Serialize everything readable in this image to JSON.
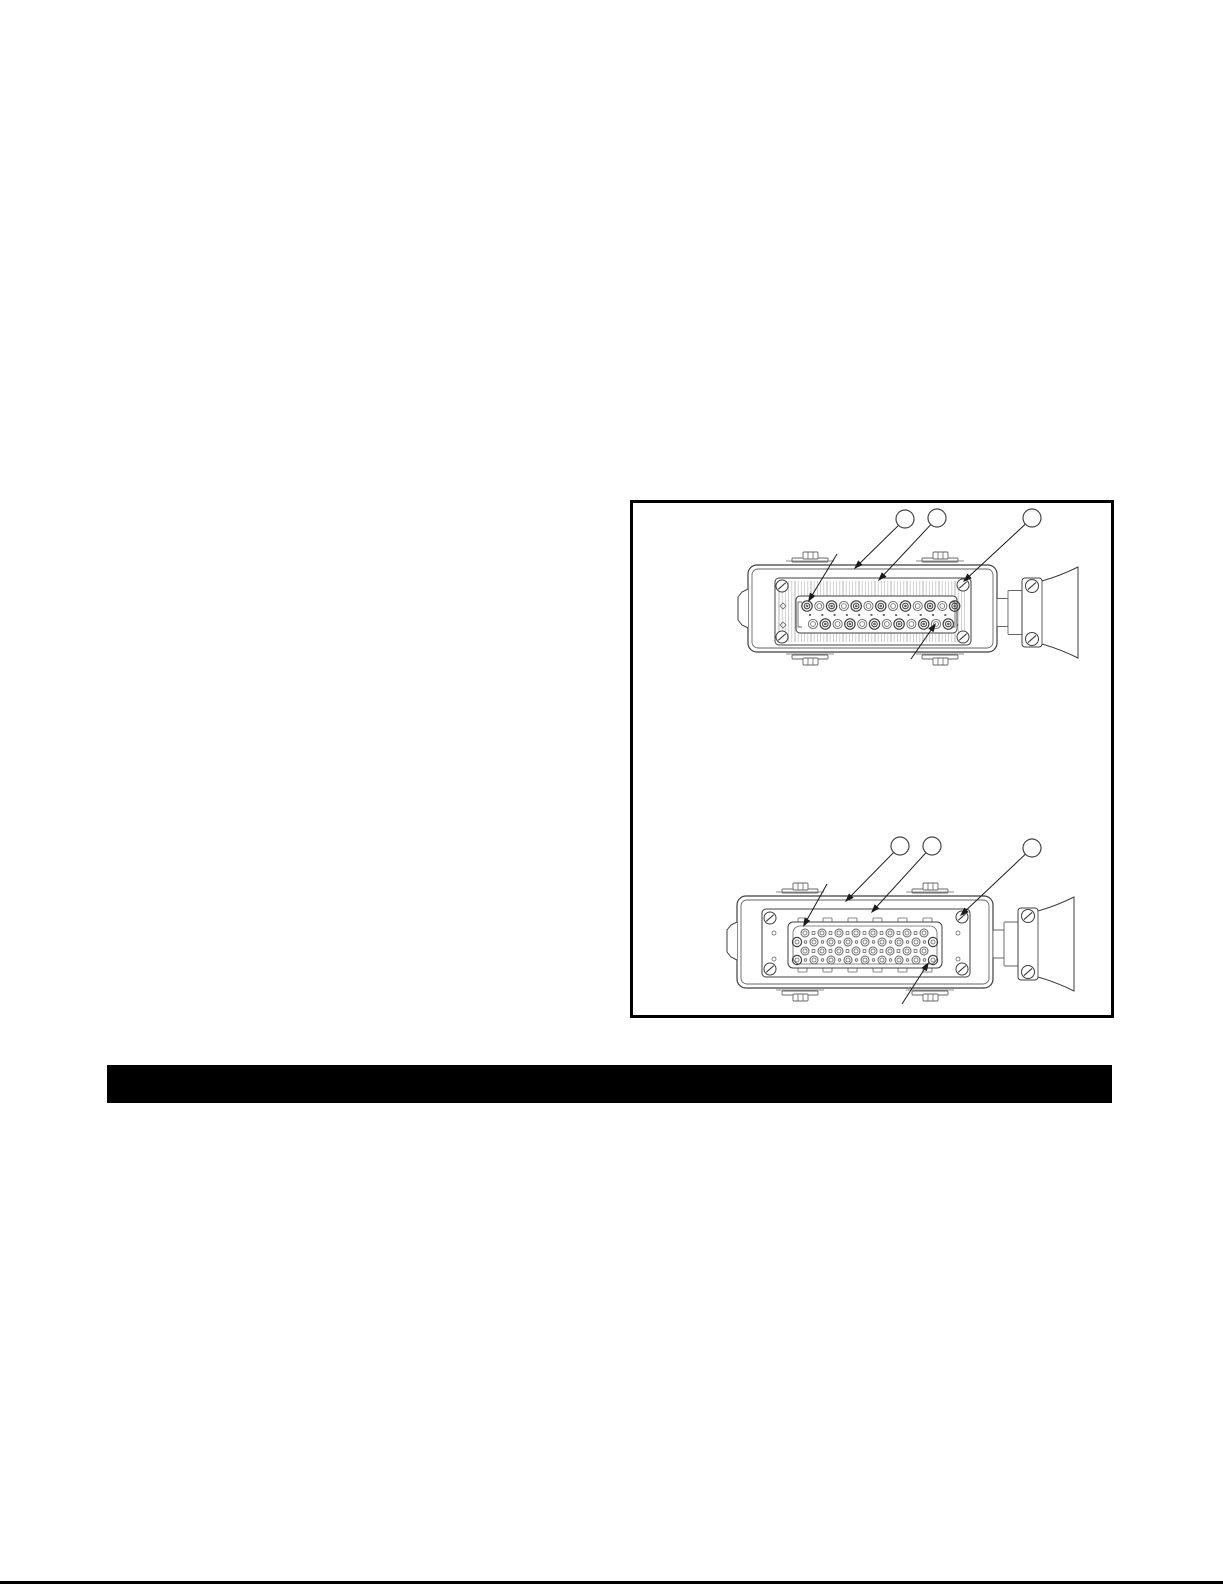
{
  "page": {
    "kind": "technical-manual-page",
    "background": "#ffffff",
    "visible_text": []
  },
  "colors": {
    "ink": "#1a1a1a",
    "outline": "#3f3f3f",
    "detail": "#666666",
    "hatch_light": "#c6c6c6",
    "hatch_dark": "#9d9d9d",
    "divider_bar": "#000000",
    "figure_border": "#000000",
    "bottom_rule": "#000000"
  },
  "figure": {
    "description": "two line drawings of rectangular heavy-duty multi-pin connectors with cable-gland bell at right, empty numbered-callout balloons",
    "diagrams": [
      {
        "id": "connector-2row",
        "kind": "rectangular-connector-face-2-row-insert",
        "hatched_face": true,
        "pin_rows": [
          13,
          12
        ],
        "callouts": [
          {
            "label": "",
            "cx": 272,
            "cy": 16,
            "r": 9,
            "tip_x": 221,
            "tip_y": 66
          },
          {
            "label": "",
            "cx": 304,
            "cy": 15,
            "r": 9,
            "tip_x": 245,
            "tip_y": 78
          },
          {
            "label": "",
            "cx": 399,
            "cy": 15,
            "r": 9,
            "tip_x": 330,
            "tip_y": 79
          }
        ],
        "plain_leaders": [
          {
            "x1": 204,
            "y1": 51,
            "x2": 175,
            "y2": 99
          },
          {
            "x1": 278,
            "y1": 156,
            "x2": 303,
            "y2": 120
          }
        ]
      },
      {
        "id": "connector-4row",
        "kind": "rectangular-connector-face-4-row-insert",
        "hatched_face": false,
        "medium_pins_per_row": [
          8,
          9,
          8,
          9
        ],
        "callouts": [
          {
            "label": "",
            "cx": 267,
            "cy": 343,
            "r": 9,
            "tip_x": 212,
            "tip_y": 399
          },
          {
            "label": "",
            "cx": 299,
            "cy": 343,
            "r": 9,
            "tip_x": 238,
            "tip_y": 410
          },
          {
            "label": "",
            "cx": 399,
            "cy": 345,
            "r": 9,
            "tip_x": 327,
            "tip_y": 413
          }
        ],
        "plain_leaders": [
          {
            "x1": 194,
            "y1": 381,
            "x2": 170,
            "y2": 424
          },
          {
            "x1": 269,
            "y1": 501,
            "x2": 296,
            "y2": 459
          }
        ]
      }
    ]
  },
  "divider_bar": {
    "present": true,
    "label": ""
  },
  "bottom_rule": {
    "present": true
  }
}
